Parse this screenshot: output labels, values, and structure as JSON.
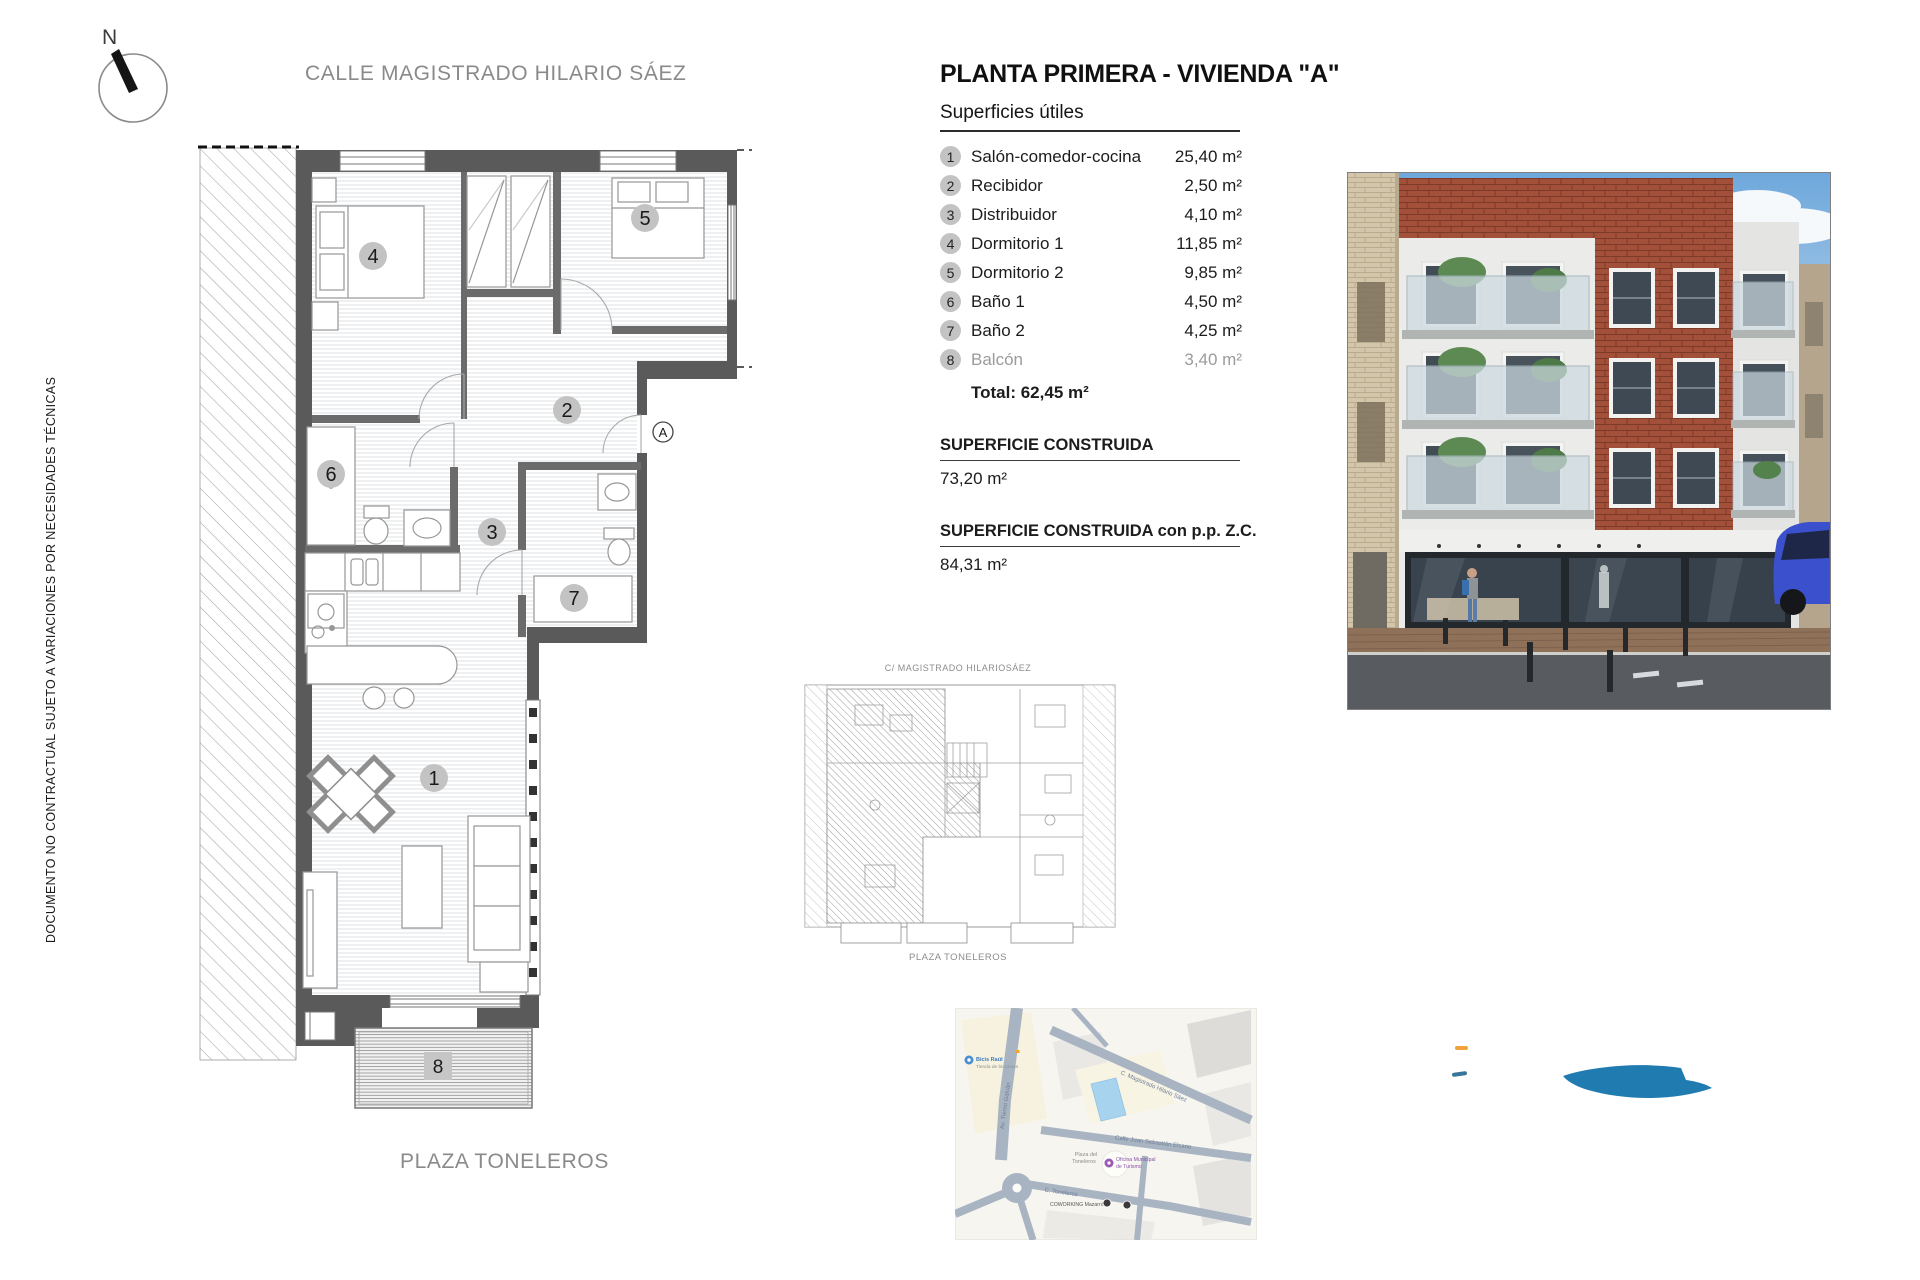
{
  "document": {
    "compass_n": "N",
    "street_top": "CALLE MAGISTRADO HILARIO SÁEZ",
    "plaza_bottom": "PLAZA TONELEROS",
    "disclaimer": "DOCUMENTO NO CONTRACTUAL SUJETO A VARIACIONES POR NECESIDADES TÉCNICAS"
  },
  "summary": {
    "title": "PLANTA PRIMERA - VIVIENDA \"A\"",
    "subtitle": "Superficies útiles",
    "rooms": [
      {
        "num": "1",
        "name": "Salón-comedor-cocina",
        "area": "25,40 m²",
        "muted": false
      },
      {
        "num": "2",
        "name": "Recibidor",
        "area": "2,50 m²",
        "muted": false
      },
      {
        "num": "3",
        "name": "Distribuidor",
        "area": "4,10 m²",
        "muted": false
      },
      {
        "num": "4",
        "name": "Dormitorio 1",
        "area": "11,85 m²",
        "muted": false
      },
      {
        "num": "5",
        "name": "Dormitorio 2",
        "area": "9,85 m²",
        "muted": false
      },
      {
        "num": "6",
        "name": "Baño 1",
        "area": "4,50 m²",
        "muted": false
      },
      {
        "num": "7",
        "name": "Baño 2",
        "area": "4,25 m²",
        "muted": false
      },
      {
        "num": "8",
        "name": "Balcón",
        "area": "3,40 m²",
        "muted": true
      }
    ],
    "total": "Total: 62,45 m²",
    "built_label": "SUPERFICIE CONSTRUIDA",
    "built_value": "73,20 m²",
    "built_zc_label": "SUPERFICIE CONSTRUIDA  con p.p. Z.C.",
    "built_zc_value": "84,31 m²"
  },
  "plan": {
    "rooms": [
      "1",
      "2",
      "3",
      "4",
      "5",
      "6",
      "7",
      "8"
    ],
    "entrance": "A"
  },
  "keyplan": {
    "street_top": "C/ MAGISTRADO HILARIOSÁEZ",
    "street_bottom": "PLAZA TONELEROS"
  },
  "map": {
    "poi_bike_name": "Bicis Raúl",
    "poi_bike_sub": "Tienda de bicicletas",
    "street_av": "Av. Tierno Galván",
    "street_magistrado": "C. Magistrado Hilario Sáez",
    "street_elcano": "Calle Juan Sebastián Elcano",
    "street_toneleros": "C. Toneleros",
    "plaza_line1": "Plaza del",
    "plaza_line2": "Toneleros",
    "poi_turismo_line1": "Oficina Municipal",
    "poi_turismo_line2": "de Turismo",
    "poi_coworking": "COWORKING Mazarrón",
    "site_color": "#a7d3ee"
  },
  "colors": {
    "accent_blue": "#1f7bb0",
    "accent_orange": "#f2a33c",
    "accent_teal": "#37759b"
  }
}
